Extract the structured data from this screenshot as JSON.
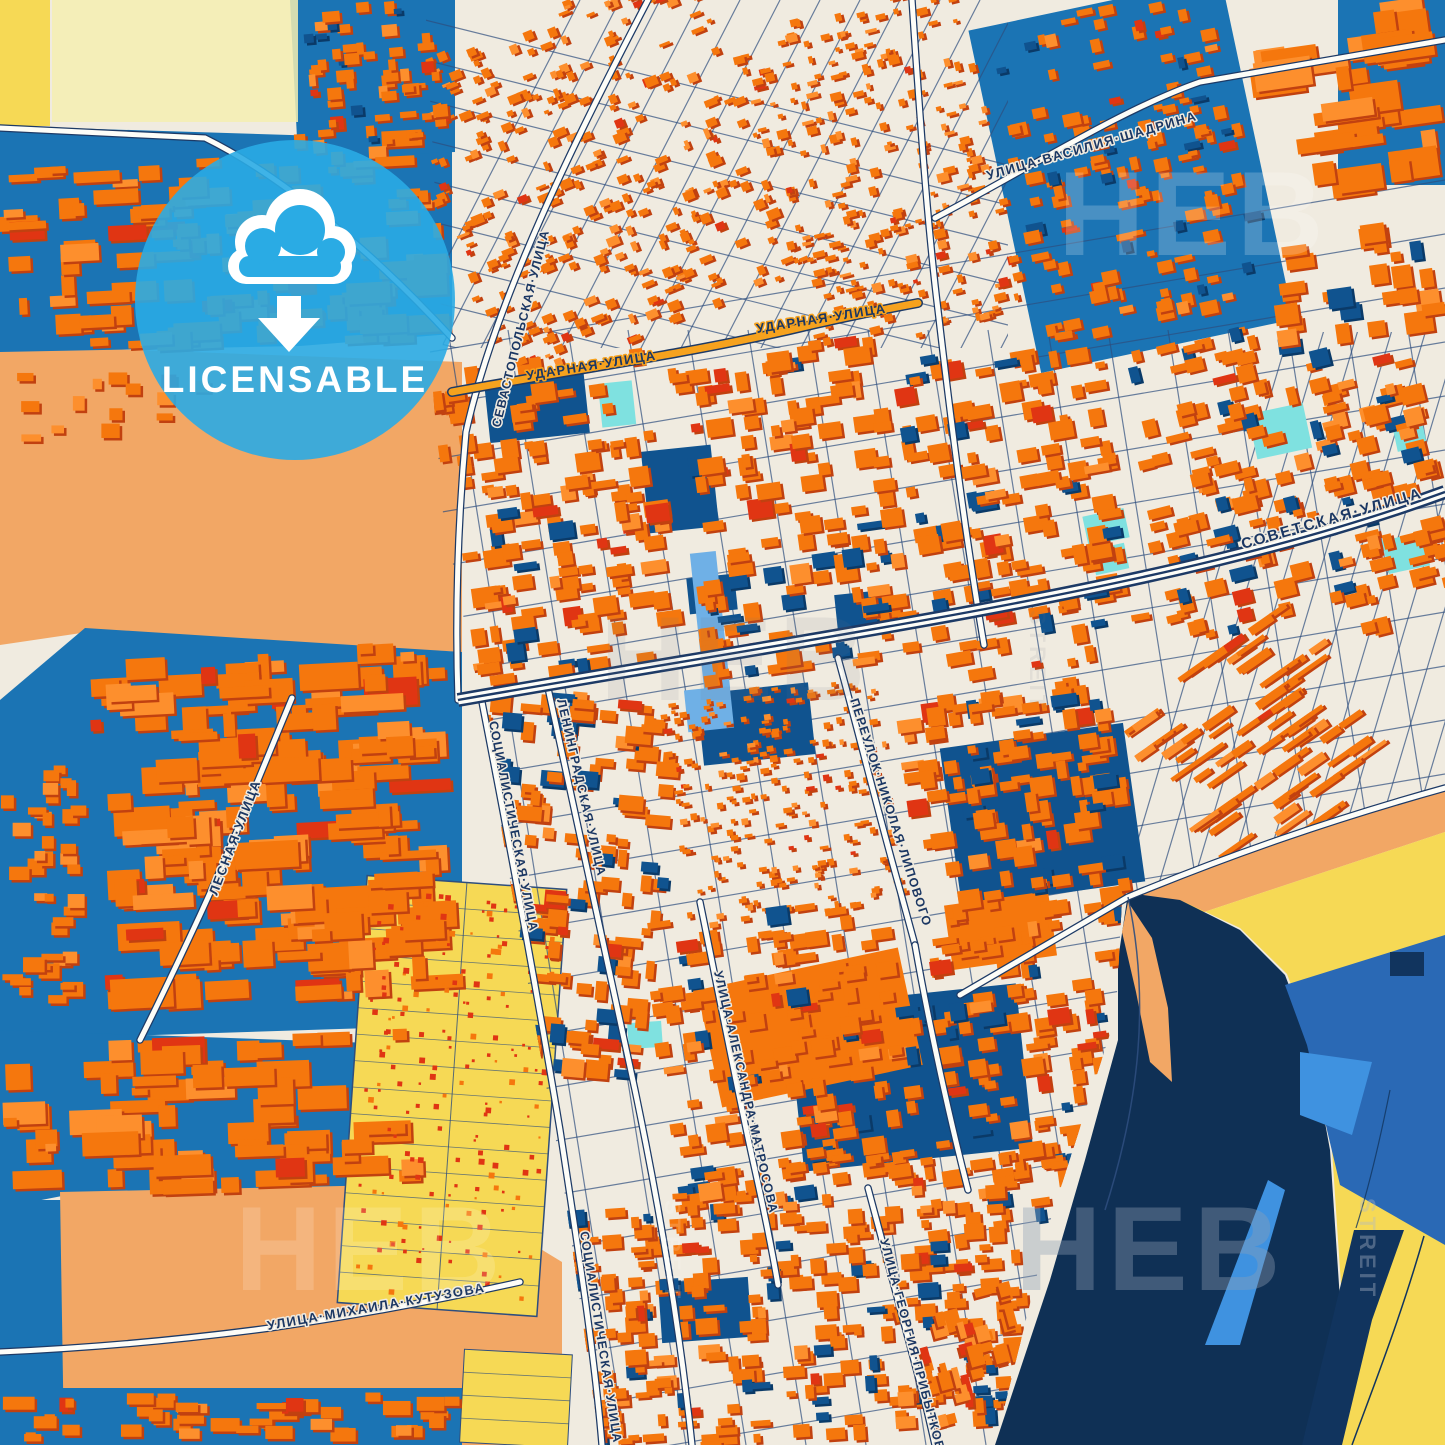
{
  "poster": {
    "kind": "city-map-poster",
    "style": "blue-orange"
  },
  "badge": {
    "label": "LICENSABLE",
    "icon": "cloud-download-icon",
    "color": "#2aabe4"
  },
  "watermark": {
    "text": "HEB",
    "vertical_text": "STREIT"
  },
  "streets": {
    "vasiliya_shadrina": "УЛИЦА·ВАСИЛИЯ·ШАДРИНА",
    "udarnaya": "УДАРНАЯ·УЛИЦА",
    "sevastopolskaya": "СЕВАСТОПОЛЬСКАЯ·УЛИЦА",
    "sovetskaya": "СОВЕТСКАЯ·УЛИЦА",
    "lesnaya": "ЛЕСНАЯ·УЛИЦА",
    "sotsialisticheskaya": "СОЦИАЛИСТИЧЕСКАЯ·УЛИЦА",
    "leningradskaya": "ЛЕНИНГРАДСКАЯ·УЛИЦА",
    "nikolaya_lipovogo": "ПЕРЕУЛОК·НИКОЛАЯ·ЛИПОВОГО",
    "aleksandra_matrosova": "УЛИЦА·АЛЕКСАНДРА·МАТРОСОВА",
    "georgiya_pribytkova": "УЛИЦА·ГЕОРГИЯ·ПРИБЫТКОВА",
    "mikhaila_kutuzova": "УЛИЦА·МИХАИЛА·КУТУЗОВА"
  },
  "palette": {
    "background": "#f0ebe0",
    "building_orange": "#f5770d",
    "building_shadow": "#c14110",
    "building_light": "#fd8f2d",
    "building_red": "#e03513",
    "building_blue": "#10538f",
    "building_blue_shadow": "#0a3a68",
    "zone_blue": "#1b74b4",
    "water_navy": "#11345e",
    "deep_water": "#0f3055",
    "field_yellow": "#f6d955",
    "field_pale_yellow": "#f4eeb0",
    "field_orange": "#f2a765",
    "pool_cyan": "#7fe1e0",
    "canal_blue": "#6fb0e6",
    "bright_blue": "#3f92e0",
    "bank_blue": "#2a69b5",
    "road_white": "#fdfdf8",
    "road_casing": "#1d3a66",
    "road_minor": "#2e4e7e",
    "highlight_road": "#f6a21e",
    "label_navy": "#1b3763"
  }
}
